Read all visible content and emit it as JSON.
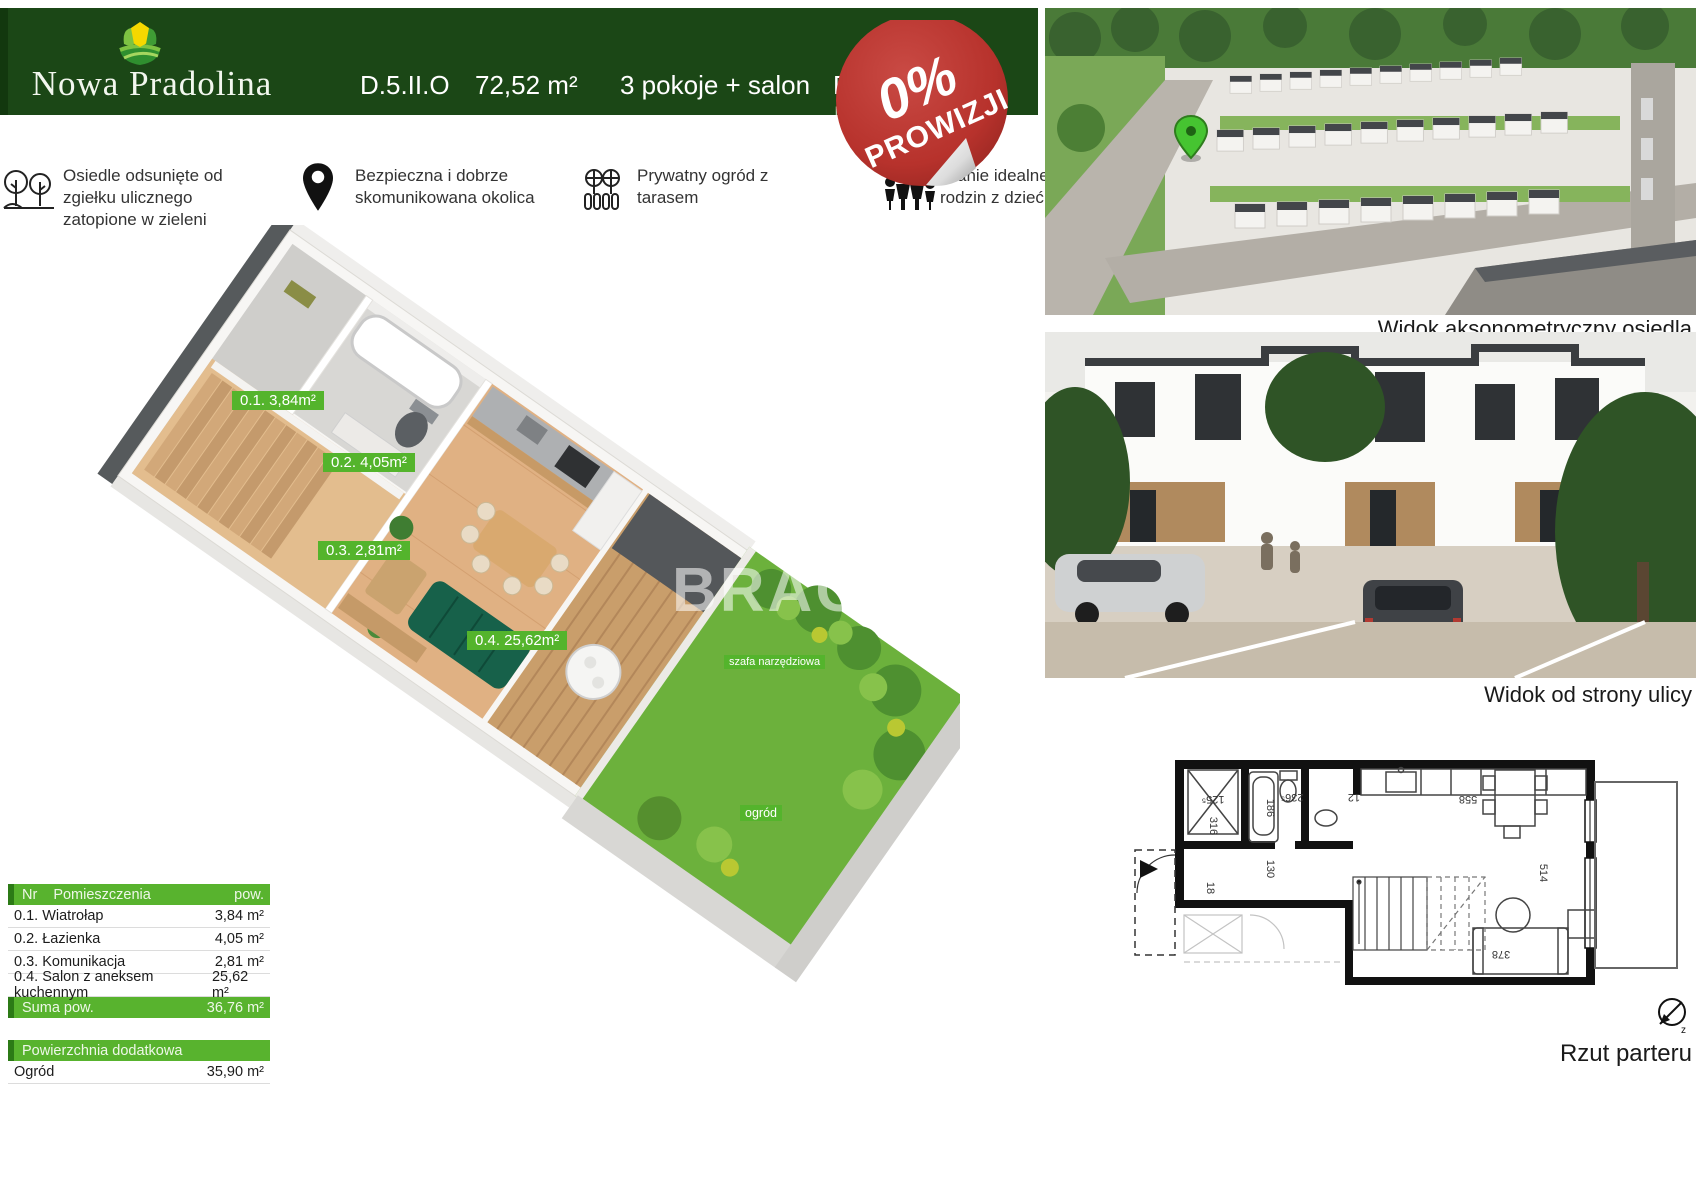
{
  "header": {
    "brand": "Nowa Pradolina",
    "unit_code": "D.5.II.O",
    "area": "72,52 m²",
    "rooms": "3 pokoje + salon",
    "floor_visible": "Pa",
    "floor_sub_visible": "lok",
    "area_extra_visible": "m²"
  },
  "sticker": {
    "percent": "0%",
    "word": "PROWIZJI"
  },
  "features": [
    {
      "icon": "trees-icon",
      "text": "Osiedle odsunięte od zgiełku ulicznego zatopione  w zieleni"
    },
    {
      "icon": "map-pin-icon",
      "text": "Bezpieczna i dobrze skomunikowana okolica"
    },
    {
      "icon": "garden-icon",
      "text": "Prywatny ogród z tarasem"
    },
    {
      "icon": "family-icon",
      "text": "zkanie idealne dla rodzin z dziećmi"
    }
  ],
  "plan3d": {
    "labels": {
      "l1": "0.1. 3,84m²",
      "l2": "0.2. 4,05m²",
      "l3": "0.3. 2,81m²",
      "l4": "0.4. 25,62m²",
      "szafa": "szafa narzędziowa",
      "ogrod": "ogród"
    },
    "watermark": "BRACIA"
  },
  "rooms_table": {
    "header": {
      "nr": "Nr",
      "name": "Pomieszczenia",
      "area": "pow."
    },
    "rows": [
      {
        "label": "0.1. Wiatrołap",
        "value": "3,84 m²"
      },
      {
        "label": "0.2. Łazienka",
        "value": "4,05 m²"
      },
      {
        "label": "0.3. Komunikacja",
        "value": "2,81 m²"
      },
      {
        "label": "0.4. Salon z aneksem kuchennym",
        "value": "25,62 m²"
      }
    ],
    "total": {
      "label": "Suma pow.",
      "value": "36,76 m²"
    },
    "extra_header": "Powierzchnia dodatkowa",
    "extra_row": {
      "label": "Ogród",
      "value": "35,90 m²"
    }
  },
  "captions": {
    "aerial": "Widok aksonometryczny osiedla",
    "street": "Widok od strony ulicy",
    "floorplan": "Rzut parteru"
  },
  "tech_plan": {
    "dims": {
      "d125": "125⁵",
      "d316": "316",
      "d18": "18",
      "d186": "186",
      "d236": "236⁵",
      "d12": "12",
      "d558": "558",
      "d130": "130",
      "d514": "514",
      "d378": "378"
    },
    "compass": "z"
  },
  "colors": {
    "header_green": "#1b4716",
    "accent_green": "#54b42c",
    "sticker_red": "#b7322c"
  }
}
